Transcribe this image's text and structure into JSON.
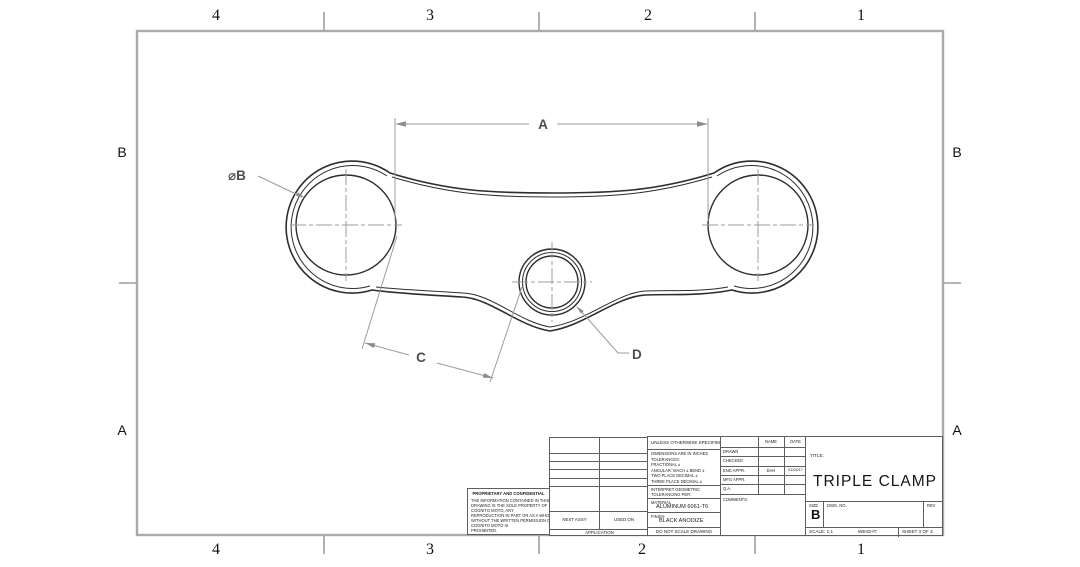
{
  "sheet": {
    "zone_columns": [
      "4",
      "3",
      "2",
      "1"
    ],
    "zone_rows": [
      "B",
      "A"
    ]
  },
  "drawing": {
    "dims": {
      "a": "A",
      "b": "⌀B",
      "c": "C",
      "d": "D"
    }
  },
  "title_block": {
    "proprietary": {
      "header": "PROPRIETARY AND CONFIDENTIAL",
      "lines": [
        "THE INFORMATION CONTAINED IN THIS",
        "DRAWING IS THE SOLE PROPERTY OF",
        "COGNITO MOTO.  ANY",
        "REPRODUCTION IN PART OR AS A WHOLE",
        "WITHOUT THE WRITTEN PERMISSION OF",
        "COGNITO MOTO IS",
        "PROHIBITED."
      ]
    },
    "application_table": {
      "next_assy": "NEXT ASSY",
      "used_on": "USED ON",
      "application": "APPLICATION"
    },
    "spec": {
      "header": "UNLESS OTHERWISE SPECIFIED:",
      "tolerances": [
        "DIMENSIONS ARE IN INCHES",
        "TOLERANCES:",
        "FRACTIONAL ±",
        "ANGULAR: MACH ±   BEND ±",
        "TWO PLACE DECIMAL    ±",
        "THREE PLACE DECIMAL  ±"
      ],
      "interpret_1": "INTERPRET GEOMETRIC",
      "interpret_2": "TOLERANCING PER:",
      "material_label": "MATERIAL",
      "material": "ALUMINUM 6061-T6",
      "finish_label": "FINISH",
      "finish": "BLACK ANODIZE",
      "do_not_scale": "DO NOT SCALE DRAWING"
    },
    "approvals": {
      "name_header": "NAME",
      "date_header": "DATE",
      "rows": [
        {
          "label": "DRAWN",
          "name": "",
          "date": ""
        },
        {
          "label": "CHECKED",
          "name": "",
          "date": ""
        },
        {
          "label": "ENG APPR.",
          "name": "DAH",
          "date": "01/04/17"
        },
        {
          "label": "MFG APPR.",
          "name": "",
          "date": ""
        },
        {
          "label": "Q.A.",
          "name": "",
          "date": ""
        },
        {
          "label": "COMMENTS:",
          "name": "",
          "date": ""
        }
      ]
    },
    "title_label": "TITLE:",
    "title": "TRIPLE CLAMP",
    "size_label": "SIZE",
    "size": "B",
    "dwg_no_label": "DWG. NO.",
    "rev_label": "REV",
    "scale": "SCALE: 1:1",
    "weight": "WEIGHT:",
    "sheet_label": "SHEET 3 OF 3"
  }
}
